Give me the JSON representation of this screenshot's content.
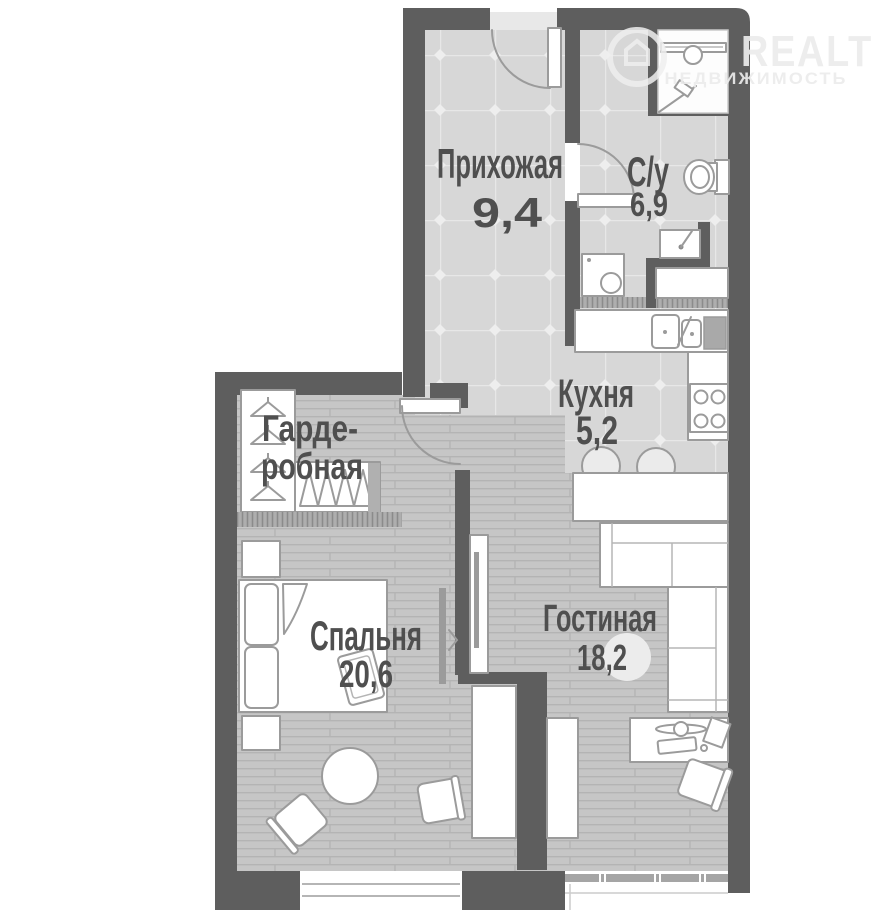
{
  "watermark": {
    "brand": "REALT",
    "tagline": "НЕДВИЖИМОСТЬ"
  },
  "rooms": {
    "hallway": {
      "name": "Прихожая",
      "area": "9,4"
    },
    "bathroom": {
      "name": "С/у",
      "area": "6,9"
    },
    "kitchen": {
      "name": "Кухня",
      "area": "5,2"
    },
    "wardrobe": {
      "name_line1": "Гарде-",
      "name_line2": "робная"
    },
    "bedroom": {
      "name": "Спальня",
      "area": "20,6"
    },
    "living": {
      "name": "Гостиная",
      "area": "18,2"
    }
  },
  "icons": {
    "logo-house-icon": "house in circle watermark",
    "hanger-icon": "clothes hanger",
    "shower-icon": "shower cabin with head",
    "toilet-icon": "toilet with tank",
    "basin-icon": "wash basin with tap",
    "washing-machine-icon": "washer with round door",
    "kitchen-sink-icon": "double bowl sink with tap",
    "stove-icon": "4-burner hob",
    "stool-icon": "round bar stool",
    "sofa-icon": "corner sofa",
    "tv-icon": "wall tv panel",
    "bed-icon": "double bed with pillows",
    "desk-icon": "desk with computer",
    "office-chair-icon": "swivel chair",
    "table-icon": "round table",
    "door-swing-icon": "door leaf with arc",
    "window-icon": "window with sill"
  },
  "colors": {
    "wall": "#5e5e5e",
    "floor_tile": "#d7d7d7",
    "floor_plank": "#c6c6c6",
    "furniture_stroke": "#9b9b9b",
    "label_text": "#4f4f4f",
    "hatch": "#8b8b8b",
    "watermark": "#ececec"
  }
}
